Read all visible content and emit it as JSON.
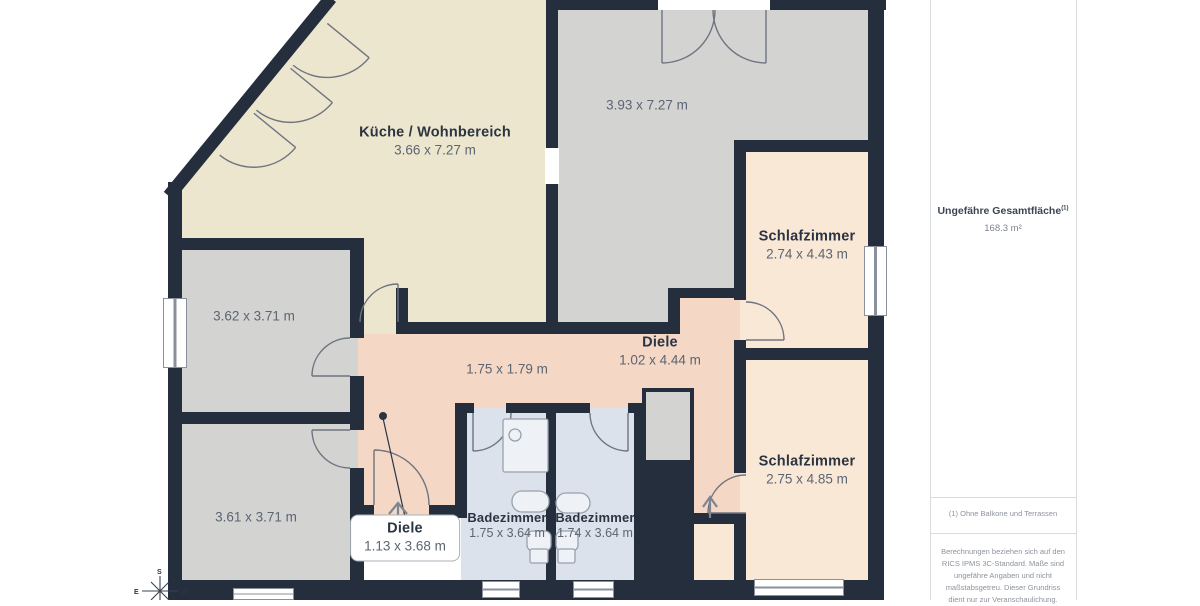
{
  "colors": {
    "wall": "#242e3d",
    "cream": "#ede6ce",
    "gray": "#d3d3d2",
    "peach": "#fae8d7",
    "pink": "#f4d7c5",
    "bath": "#dce2eb",
    "accentText": "#2b3442",
    "dimText": "#5c6573",
    "muted": "#8d939c"
  },
  "floorplan": {
    "rooms": [
      {
        "id": "kueche",
        "name": "Küche / Wohnbereich",
        "dims": "3.66 x 7.27 m"
      },
      {
        "id": "top_right_room",
        "name": "",
        "dims": "3.93 x 7.27 m"
      },
      {
        "id": "schlafzimmer_1",
        "name": "Schlafzimmer",
        "dims": "2.74 x 4.43 m"
      },
      {
        "id": "schlafzimmer_2",
        "name": "Schlafzimmer",
        "dims": "2.75 x 4.85 m"
      },
      {
        "id": "left_room_1",
        "name": "",
        "dims": "3.62 x 3.71 m"
      },
      {
        "id": "left_room_2",
        "name": "",
        "dims": "3.61 x 3.71 m"
      },
      {
        "id": "diele",
        "name": "Diele",
        "dims": "1.02 x 4.44 m"
      },
      {
        "id": "flur",
        "name": "",
        "dims": "1.75 x 1.79 m"
      },
      {
        "id": "badezimmer_1",
        "name": "Badezimmer",
        "dims": "1.75 x 3.64 m"
      },
      {
        "id": "badezimmer_2",
        "name": "Badezimmer",
        "dims": "1.74 x 3.64 m"
      },
      {
        "id": "diele_entry",
        "name": "Diele",
        "dims": "1.13 x 3.68 m"
      }
    ],
    "compass": {
      "s": "S",
      "e": "E",
      "w": "W"
    }
  },
  "sidebar": {
    "title": "Ungefähre Gesamtfläche",
    "title_sup": "(1)",
    "area_value": "168.3 m²",
    "footnote": "(1) Ohne Balkone und Terrassen",
    "disclaimer": "Berechnungen beziehen sich auf den RICS IPMS 3C-Standard. Maße sind ungefähre Angaben und nicht maßstabsgetreu. Dieser Grundriss dient nur zur Veranschaulichung."
  }
}
